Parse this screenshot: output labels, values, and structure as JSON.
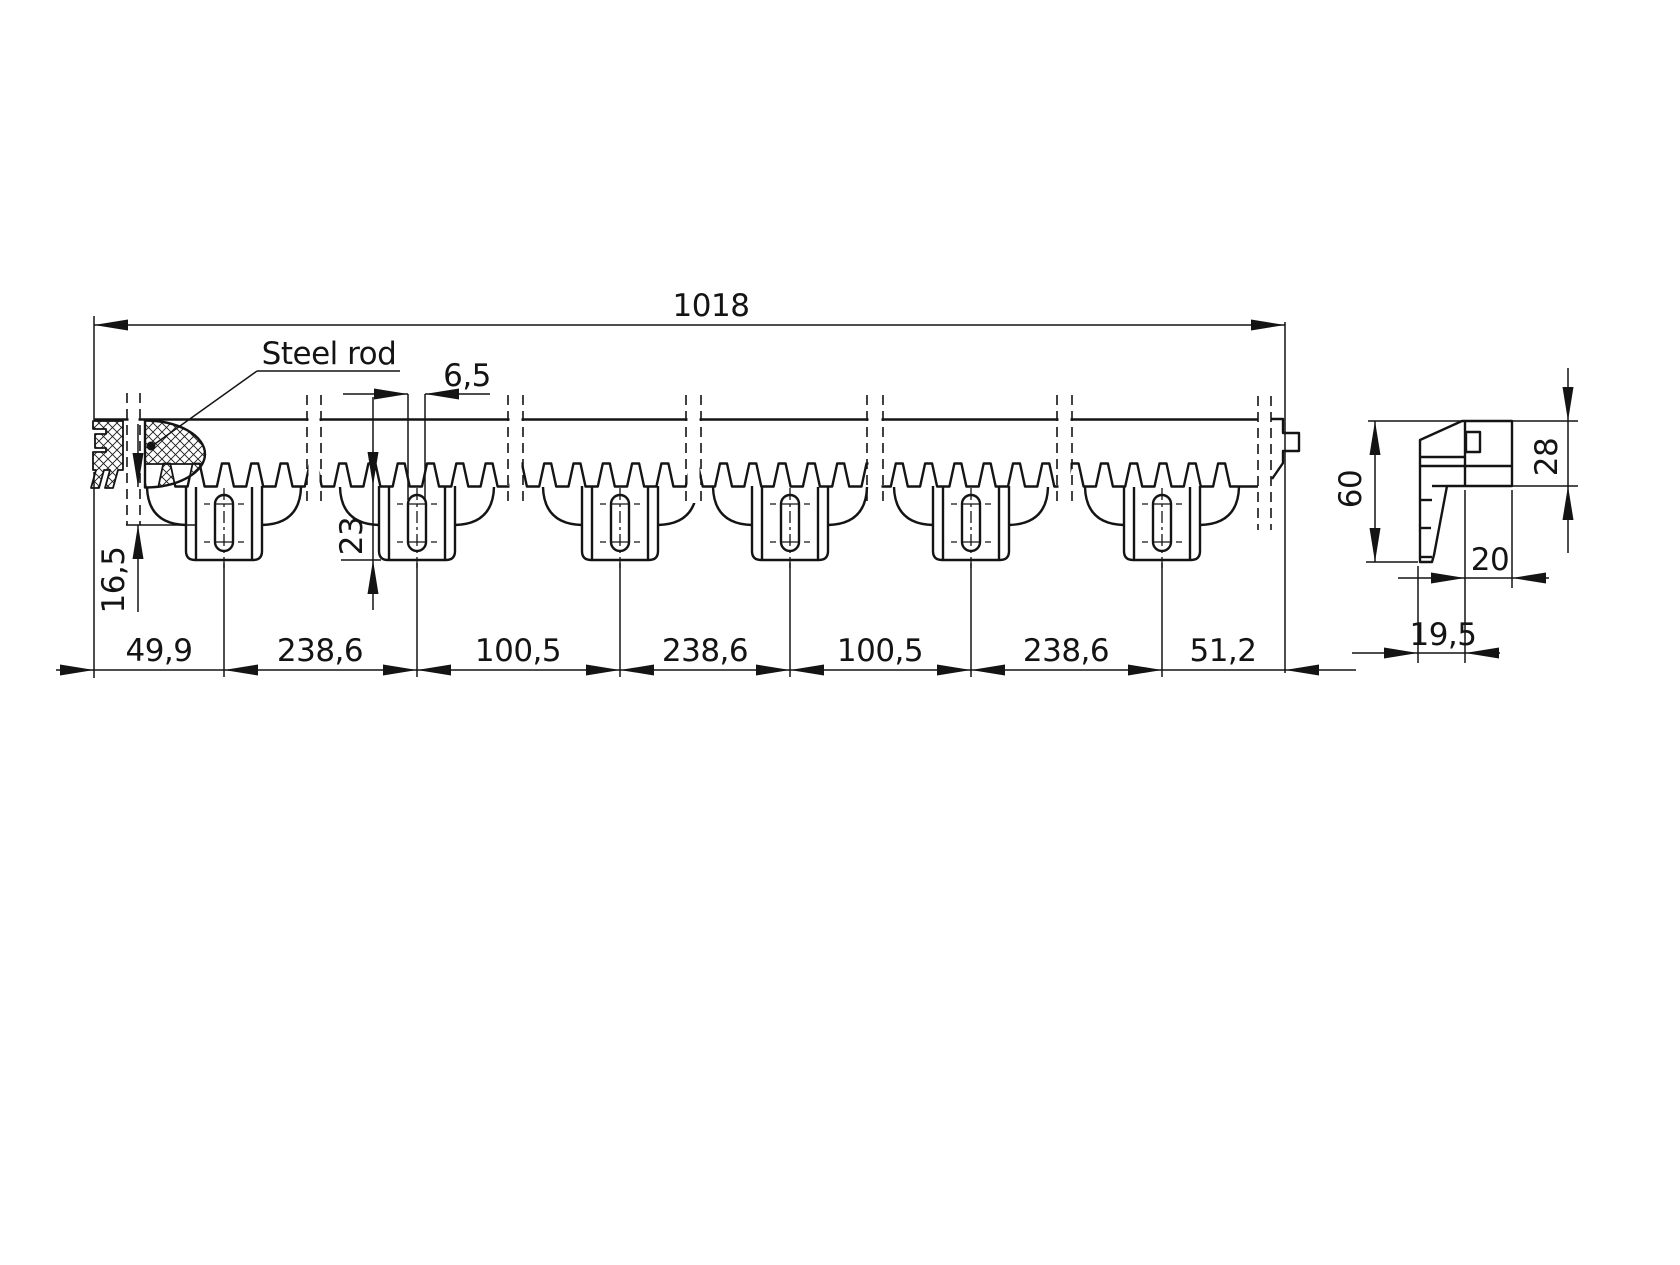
{
  "drawing": {
    "kind": "technical-dimension-drawing",
    "callout_label": "Steel rod",
    "dimensions": {
      "overall_length": "1018",
      "slot_width": "6,5",
      "bracket_depth": "23",
      "flange_depth": "16,5",
      "spacings": [
        "49,9",
        "238,6",
        "100,5",
        "238,6",
        "100,5",
        "238,6",
        "51,2"
      ],
      "side_height": "60",
      "side_head_height": "28",
      "side_width": "20",
      "side_foot_offset": "19,5"
    },
    "colors": {
      "ink": "#141414",
      "background": "#ffffff"
    }
  }
}
